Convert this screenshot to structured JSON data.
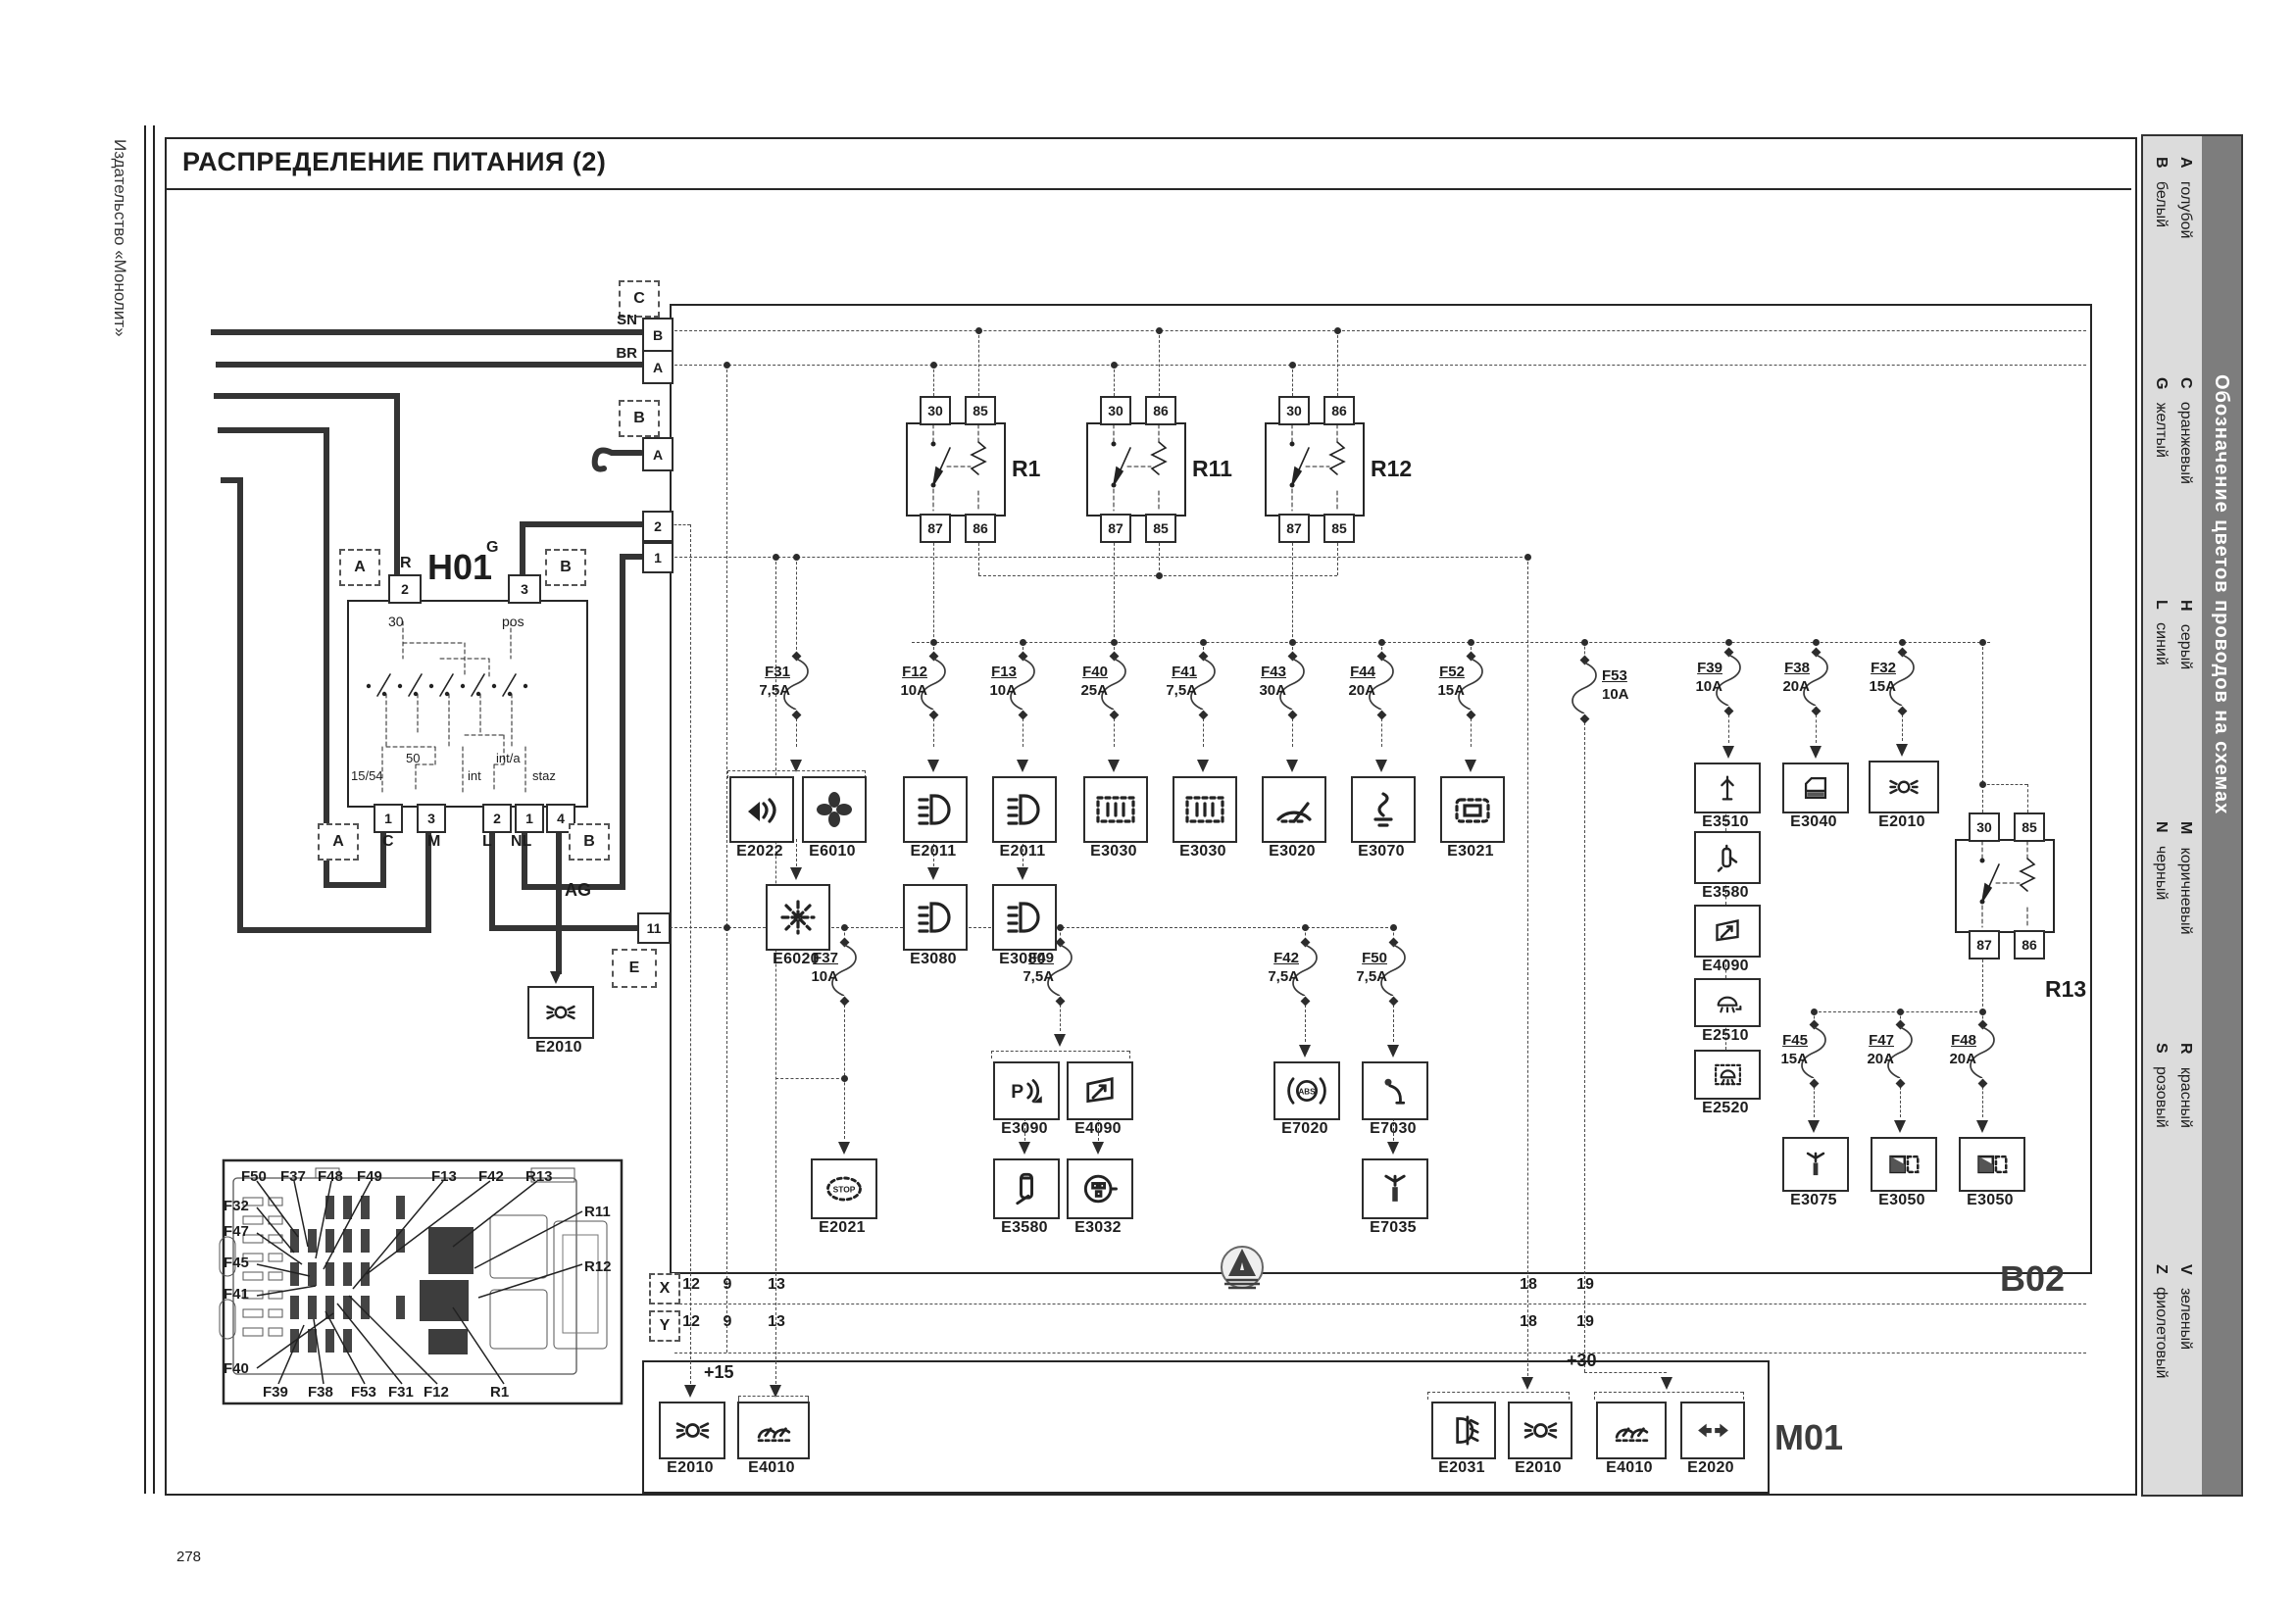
{
  "page": {
    "title": "РАСПРЕДЕЛЕНИЕ ПИТАНИЯ (2)",
    "publisher": "Издательство «Монолит»",
    "number": "278"
  },
  "legend": {
    "title": "Обозначение цветов проводов на схемах",
    "entries": [
      {
        "code": "A",
        "name": "голубой"
      },
      {
        "code": "B",
        "name": "белый"
      },
      {
        "code": "C",
        "name": "оранжевый"
      },
      {
        "code": "G",
        "name": "желтый"
      },
      {
        "code": "H",
        "name": "серый"
      },
      {
        "code": "L",
        "name": "синий"
      },
      {
        "code": "M",
        "name": "коричневый"
      },
      {
        "code": "N",
        "name": "черный"
      },
      {
        "code": "R",
        "name": "красный"
      },
      {
        "code": "S",
        "name": "розовый"
      },
      {
        "code": "V",
        "name": "зеленый"
      },
      {
        "code": "Z",
        "name": "фиолетовый"
      }
    ]
  },
  "blocks": {
    "b02": "B02",
    "m01": "M01",
    "h01": "H01"
  },
  "connectors": {
    "c": {
      "label": "C",
      "pins": [
        {
          "pin": "B",
          "wire": "SN"
        },
        {
          "pin": "A",
          "wire": "BR"
        }
      ]
    },
    "b": {
      "label": "B",
      "pin": "A"
    },
    "e": {
      "label": "E"
    },
    "edge_pins": [
      "2",
      "1",
      "11"
    ]
  },
  "h01": {
    "top_pins": [
      "2",
      "3"
    ],
    "top_wires": [
      "R",
      "G"
    ],
    "inner_top": [
      "30",
      "pos"
    ],
    "inner_bottom": [
      "15/54",
      "50",
      "int",
      "int/a",
      "staz"
    ],
    "bottom_pins": [
      "1",
      "3",
      "2",
      "1",
      "4"
    ],
    "bottom_wires": [
      "C",
      "M",
      "L",
      "NL"
    ],
    "connector_left": "A",
    "connector_right": "B",
    "ag": "AG"
  },
  "relays": [
    {
      "id": "R1",
      "top": [
        "30",
        "85"
      ],
      "bottom": [
        "87",
        "86"
      ]
    },
    {
      "id": "R11",
      "top": [
        "30",
        "86"
      ],
      "bottom": [
        "87",
        "85"
      ]
    },
    {
      "id": "R12",
      "top": [
        "30",
        "86"
      ],
      "bottom": [
        "87",
        "85"
      ]
    },
    {
      "id": "R13",
      "top": [
        "30",
        "85"
      ],
      "bottom": [
        "87",
        "86"
      ]
    }
  ],
  "fuses": [
    {
      "id": "F31",
      "amps": "7,5A"
    },
    {
      "id": "F12",
      "amps": "10A"
    },
    {
      "id": "F13",
      "amps": "10A"
    },
    {
      "id": "F40",
      "amps": "25A"
    },
    {
      "id": "F41",
      "amps": "7,5A"
    },
    {
      "id": "F43",
      "amps": "30A"
    },
    {
      "id": "F44",
      "amps": "20A"
    },
    {
      "id": "F52",
      "amps": "15A"
    },
    {
      "id": "F53",
      "amps": "10A"
    },
    {
      "id": "F39",
      "amps": "10A"
    },
    {
      "id": "F38",
      "amps": "20A"
    },
    {
      "id": "F32",
      "amps": "15A"
    },
    {
      "id": "F37",
      "amps": "10A"
    },
    {
      "id": "F49",
      "amps": "7,5A"
    },
    {
      "id": "F42",
      "amps": "7,5A"
    },
    {
      "id": "F50",
      "amps": "7,5A"
    },
    {
      "id": "F45",
      "amps": "15A"
    },
    {
      "id": "F47",
      "amps": "20A"
    },
    {
      "id": "F48",
      "amps": "20A"
    }
  ],
  "components": [
    {
      "id": "E2022",
      "icon": "horn"
    },
    {
      "id": "E6010",
      "icon": "fan"
    },
    {
      "id": "E2011",
      "icon": "lowbeam"
    },
    {
      "id": "E2011",
      "icon": "lowbeam"
    },
    {
      "id": "E3030",
      "icon": "cluster"
    },
    {
      "id": "E3030",
      "icon": "cluster"
    },
    {
      "id": "E3020",
      "icon": "wiper"
    },
    {
      "id": "E3070",
      "icon": "lighter"
    },
    {
      "id": "E3021",
      "icon": "socket"
    },
    {
      "id": "E6020",
      "icon": "ac"
    },
    {
      "id": "E3080",
      "icon": "lowbeam"
    },
    {
      "id": "E3080",
      "icon": "lowbeam"
    },
    {
      "id": "E3510",
      "icon": "antenna"
    },
    {
      "id": "E3040",
      "icon": "door"
    },
    {
      "id": "E2010",
      "icon": "beam"
    },
    {
      "id": "E3580",
      "icon": "pump"
    },
    {
      "id": "E4090",
      "icon": "mirror"
    },
    {
      "id": "E2510",
      "icon": "dome"
    },
    {
      "id": "E2520",
      "icon": "dome2"
    },
    {
      "id": "E2021",
      "icon": "stop"
    },
    {
      "id": "E3090",
      "icon": "psensor"
    },
    {
      "id": "E4090",
      "icon": "mirror"
    },
    {
      "id": "E3580",
      "icon": "phone"
    },
    {
      "id": "E3032",
      "icon": "plug"
    },
    {
      "id": "E7020",
      "icon": "abs"
    },
    {
      "id": "E7030",
      "icon": "column"
    },
    {
      "id": "E7035",
      "icon": "spray"
    },
    {
      "id": "E3075",
      "icon": "spray"
    },
    {
      "id": "E3050",
      "icon": "window"
    },
    {
      "id": "E3050",
      "icon": "window"
    },
    {
      "id": "E2010",
      "icon": "beam"
    },
    {
      "id": "E2010",
      "icon": "beam"
    },
    {
      "id": "E4010",
      "icon": "gauge"
    },
    {
      "id": "E2031",
      "icon": "fog"
    },
    {
      "id": "E2010",
      "icon": "beam"
    },
    {
      "id": "E4010",
      "icon": "gauge"
    },
    {
      "id": "E2020",
      "icon": "turns"
    }
  ],
  "strip": {
    "rows": [
      "X",
      "Y"
    ],
    "columns": [
      "12",
      "9",
      "13",
      "18",
      "19"
    ],
    "plus15": "+15",
    "plus30": "+30"
  },
  "inset": {
    "labels": [
      "F50",
      "F37",
      "F48",
      "F49",
      "F13",
      "F42",
      "R13",
      "F32",
      "F47",
      "F45",
      "F41",
      "F40",
      "F39",
      "F38",
      "F53",
      "F31",
      "F12",
      "R1",
      "R11",
      "R12"
    ]
  },
  "icon_text": {
    "stop": "STOP",
    "abs": "ABS",
    "psensor": "P"
  }
}
